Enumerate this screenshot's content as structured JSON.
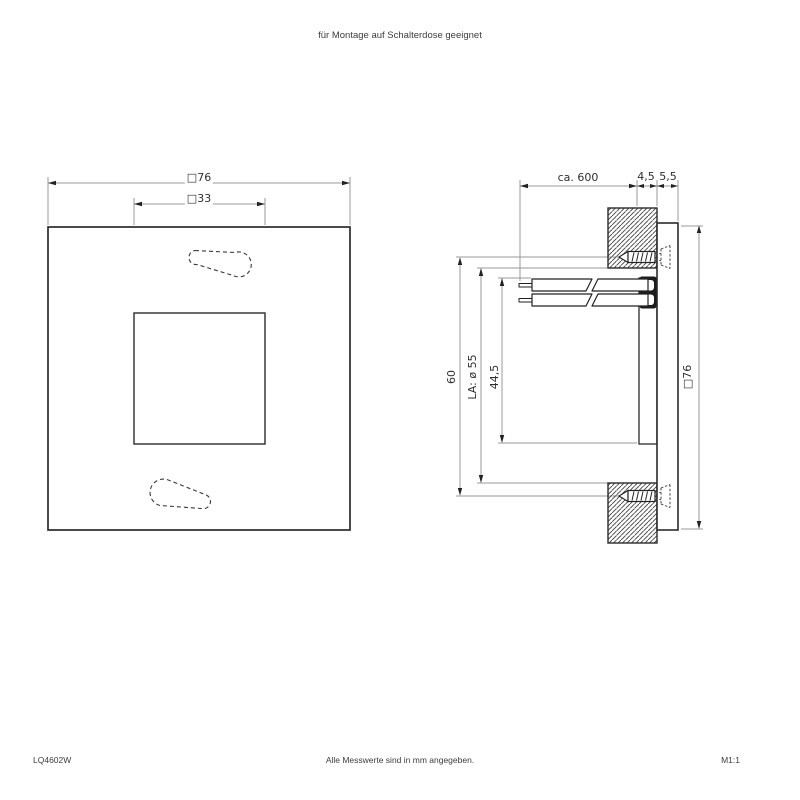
{
  "header": {
    "note": "für Montage auf Schalterdose geeignet"
  },
  "front_view": {
    "dim_outer": "□76",
    "dim_inner": "□33"
  },
  "side_view": {
    "dim_cable_length": "ca. 600",
    "dim_recess_depth": "4,5",
    "dim_panel_thickness": "5,5",
    "dim_screw_spacing": "60",
    "dim_cutout": "LA: ø 55",
    "dim_body_size": "44,5",
    "dim_panel_size": "□76"
  },
  "footer": {
    "model": "LQ4602W",
    "note": "Alle Messwerte sind in mm angegeben.",
    "scale": "M1:1"
  },
  "colors": {
    "line": "#2b2b2b",
    "dimension_line": "#999999",
    "hatch": "#3f3f3f",
    "text": "#333333",
    "background": "#ffffff"
  }
}
